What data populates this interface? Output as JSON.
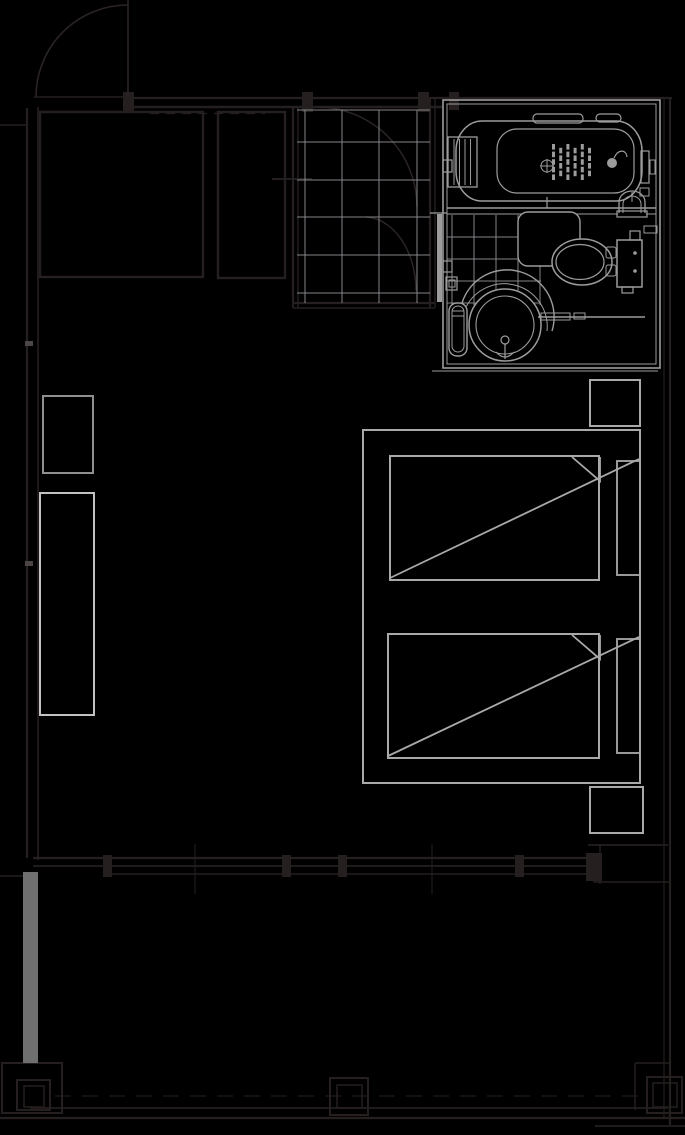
{
  "canvas": {
    "width": 685,
    "height": 1135
  },
  "colors": {
    "background": "#000000",
    "wall": "#251f1f",
    "door_arc": "#2b2424",
    "grid_line": "#85858a",
    "bath_line": "#9c9c9c",
    "furniture_line": "#a9a9a9",
    "furniture_bright": "#c2c2c2",
    "stool_line": "#8f8f8f",
    "filled_wall_bar": "#6f6f6f",
    "joint_tick": "#4b4545"
  },
  "entry_floor_grid": {
    "x_lines": [
      305,
      342,
      379,
      417
    ],
    "y_lines": [
      110,
      142,
      180,
      217,
      255,
      293
    ],
    "x_range": [
      297,
      430
    ],
    "y_range": [
      110,
      303
    ]
  },
  "bath_floor_grid": {
    "x_lines": [
      452,
      474,
      496,
      518,
      540
    ],
    "y_lines": [
      237,
      259,
      281,
      303
    ],
    "x_range": [
      447,
      541
    ],
    "y_range": [
      215,
      305
    ]
  },
  "tub_drain_mat": {
    "x": 552,
    "y": 144,
    "cols": 6,
    "rows": 5,
    "dx": 7.2,
    "dy": 7.6,
    "bar_width": 3,
    "bar_height": 5.6
  }
}
